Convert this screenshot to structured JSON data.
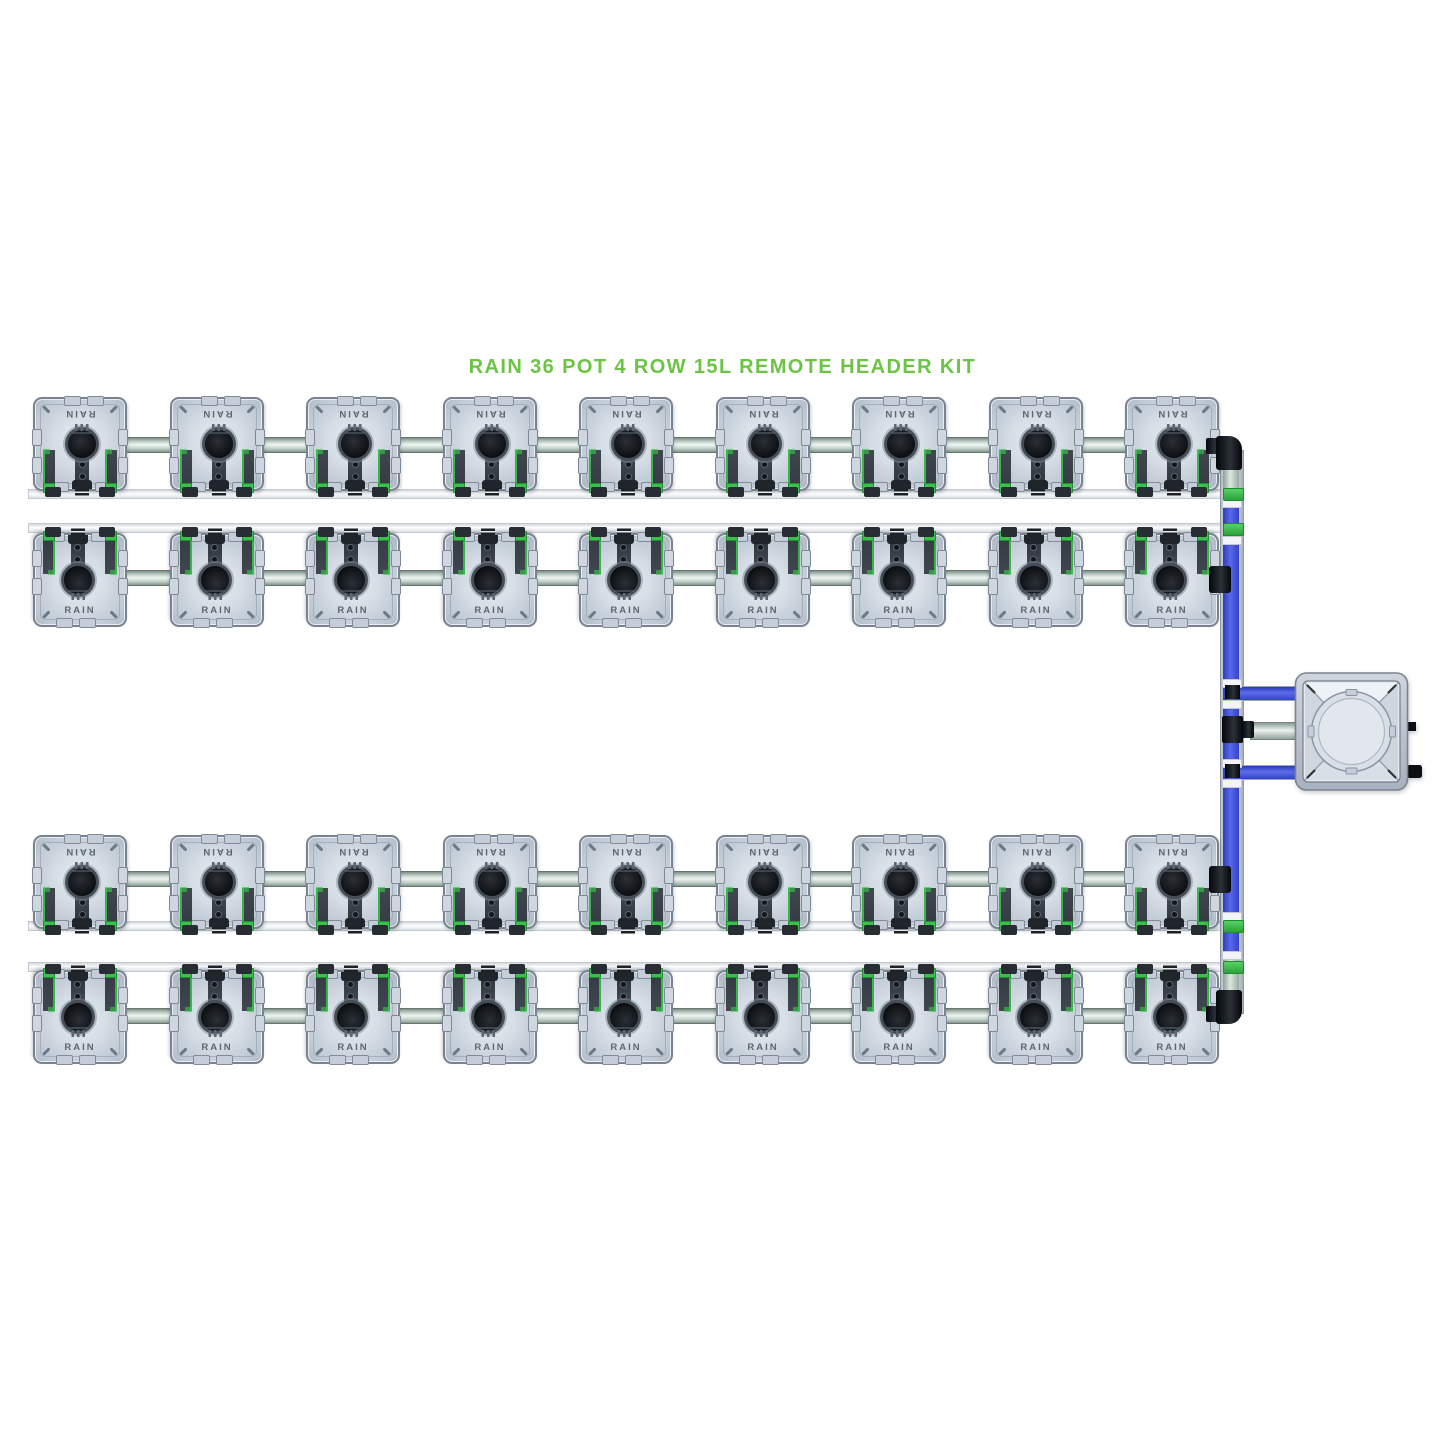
{
  "title": {
    "text": "RAIN 36 POT 4 ROW 15L REMOTE HEADER KIT",
    "color": "#6cc344"
  },
  "system": {
    "kit_name": "RAIN",
    "pot_count": 36,
    "row_count": 4,
    "pots_per_row": 9,
    "pot_size_label": "15L",
    "header_type": "REMOTE HEADER",
    "pot_label": "RAIN",
    "rows": [
      {
        "name": "row-1",
        "pots": 9,
        "orientation": "outlet-down"
      },
      {
        "name": "row-2",
        "pots": 9,
        "orientation": "outlet-up"
      },
      {
        "name": "row-3",
        "pots": 9,
        "orientation": "outlet-down"
      },
      {
        "name": "row-4",
        "pots": 9,
        "orientation": "outlet-up"
      }
    ],
    "components": {
      "feed_riser": "vertical blue pipe on right side linking all rows",
      "feed_manifold": "silver pipe through pot centers of each row",
      "return_pipe": "thin white pipe along pot feet of each row",
      "header_tank": "square remote header tank with round lid, right of rows",
      "tank_links": "two blue pipes and one silver pipe between riser and tank",
      "clips": "green pipe clips at return junctions",
      "fittings": "black elbows and tees"
    },
    "colors": {
      "title_green": "#6cc344",
      "feed_blue": "#4353de",
      "clip_green": "#3cc04c",
      "manifold_silver": "#cfdad2",
      "return_white": "#f2f4f7",
      "fitting_black": "#0c0e11",
      "pot_grey": "#c9d2dc",
      "tank_grey": "#bac3cf"
    }
  }
}
